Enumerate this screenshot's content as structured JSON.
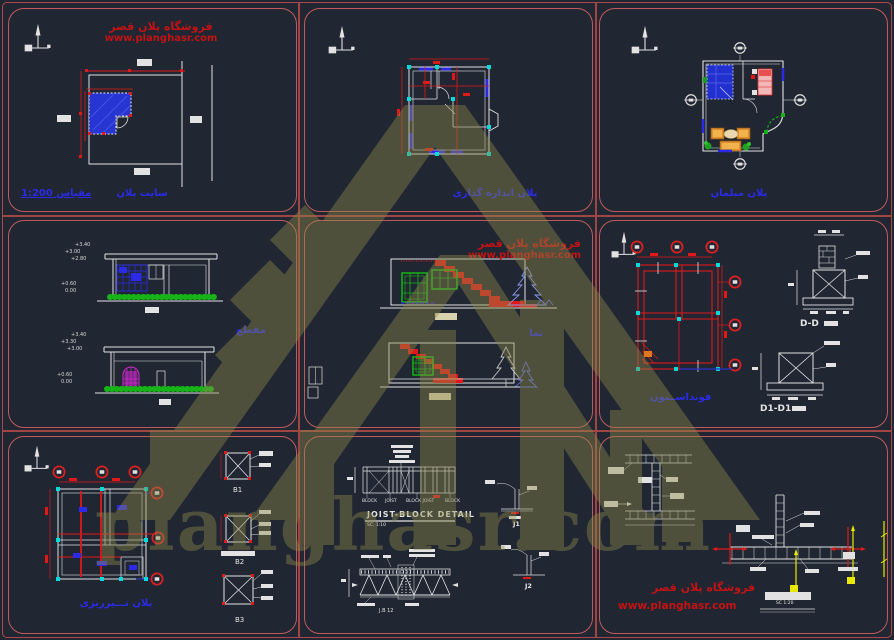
{
  "brand": {
    "store_title": "فروشگاه پلان قصر",
    "store_url": "www.planghasr.com",
    "watermark_text": "planghasr.com"
  },
  "colors": {
    "background": "#202733",
    "panel_border": "#c05a5a",
    "cad_red": "#e01818",
    "cad_blue": "#2a2ae8",
    "cad_cyan": "#00dcdc",
    "cad_green": "#16b416",
    "cad_magenta": "#d428d4",
    "cad_orange": "#d9882a",
    "cad_yellow": "#e8e800",
    "brand_red": "#c41212",
    "watermark_olive": "#8e8a4a"
  },
  "panels": {
    "site_plan": {
      "caption": "سایت پلان",
      "scale_note": "مقیاس 1:200"
    },
    "dimension_plan": {
      "caption": "پلان اندازه گذاری"
    },
    "furniture_plan": {
      "caption": "پلان مبلمان"
    },
    "sections": {
      "caption": "مقطع",
      "upper_levels": [
        "+3.40",
        "+3.00",
        "+2.80",
        "+0.60",
        "0.00"
      ],
      "lower_levels": [
        "+3.40",
        "+3.30",
        "+3.00",
        "+0.60",
        "0.00"
      ]
    },
    "elevations": {
      "caption": "نما"
    },
    "foundation": {
      "caption": "فونداســیون",
      "detail_dd_label": "D-D",
      "detail_d1d1_label": "D1-D1"
    },
    "beam_plan": {
      "caption": "پلان تـــیرریزی",
      "detail_b1": "B1",
      "detail_b2": "B2",
      "detail_b3": "B3"
    },
    "joist_block": {
      "title": "JOIST-BLOCK DETAIL",
      "scale_note": "SC. 1:10",
      "label_block_l": "BLOCK",
      "label_joist": "JOIST",
      "label_block_joist": "BLOCK JOIST",
      "label_block_r": "BLOCK",
      "label_jb": "J.B 12",
      "detail_j1": "J1",
      "detail_j2": "J2"
    },
    "wall_details": {
      "scale_note": "SC 1:20"
    }
  }
}
